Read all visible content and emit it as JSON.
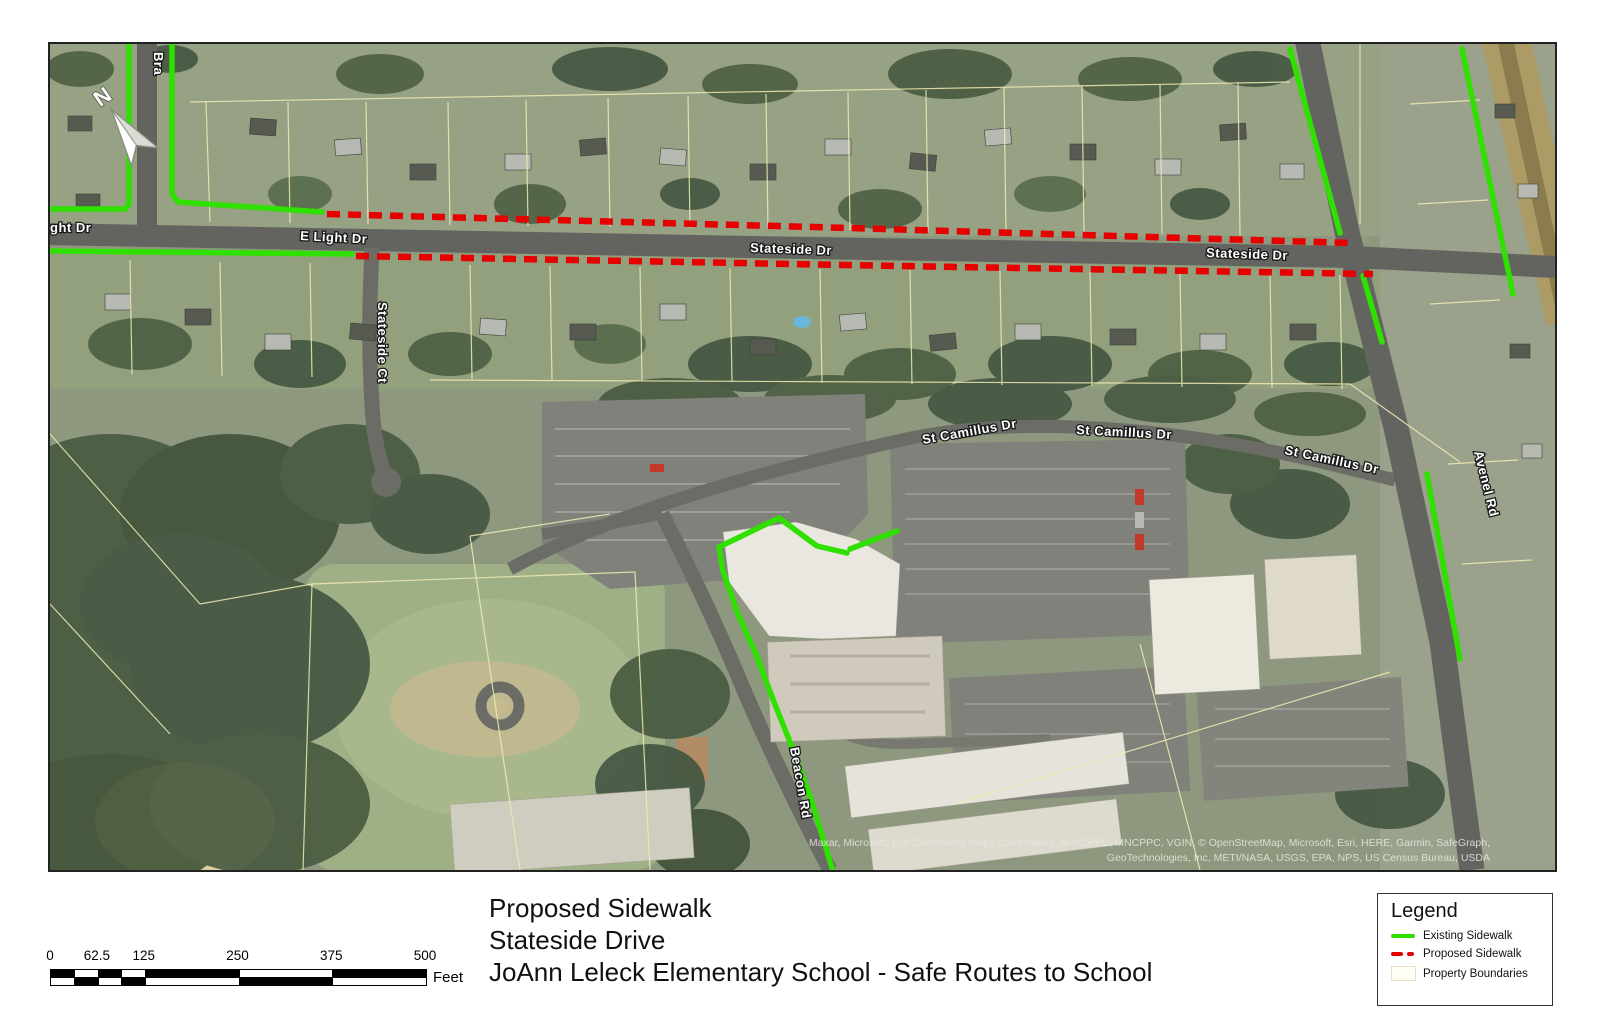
{
  "map": {
    "north_label": "N",
    "street_labels": [
      {
        "text": "Bra"
      },
      {
        "text": "ght Dr"
      },
      {
        "text": "E Light Dr"
      },
      {
        "text": "Stateside Dr"
      },
      {
        "text": "Stateside Dr"
      },
      {
        "text": "Stateside Ct"
      },
      {
        "text": "St Camillus Dr"
      },
      {
        "text": "St Camillus Dr"
      },
      {
        "text": "St Camillus Dr"
      },
      {
        "text": "Beacon Rd"
      },
      {
        "text": "Avenel Rd"
      }
    ],
    "attribution_line1": "Maxar, Microsoft, Esri Community Maps Contributors, M-NCPPC, MNCPPC, VGIN, © OpenStreetMap, Microsoft, Esri, HERE, Garmin, SafeGraph,",
    "attribution_line2": "GeoTechnologies, Inc, METI/NASA, USGS, EPA, NPS, US Census Bureau, USDA"
  },
  "scale_bar": {
    "ticks": [
      "0",
      "62.5",
      "125",
      "250",
      "375",
      "500"
    ],
    "unit": "Feet"
  },
  "title_block": {
    "line1": "Proposed Sidewalk",
    "line2": "Stateside Drive",
    "line3": "JoAnn Leleck Elementary School - Safe Routes to School"
  },
  "legend": {
    "title": "Legend",
    "items": [
      {
        "label": "Existing Sidewalk",
        "color": "#2fe000",
        "style": "solid-line"
      },
      {
        "label": "Proposed Sidewalk",
        "color": "#e60000",
        "style": "dashed-line"
      },
      {
        "label": "Property Boundaries",
        "color": "#fffef7",
        "style": "box"
      }
    ]
  },
  "colors": {
    "existing_sidewalk": "#2fe000",
    "proposed_sidewalk": "#e60000",
    "parcel_line": "#f1ecb4",
    "road": "#63645f"
  }
}
